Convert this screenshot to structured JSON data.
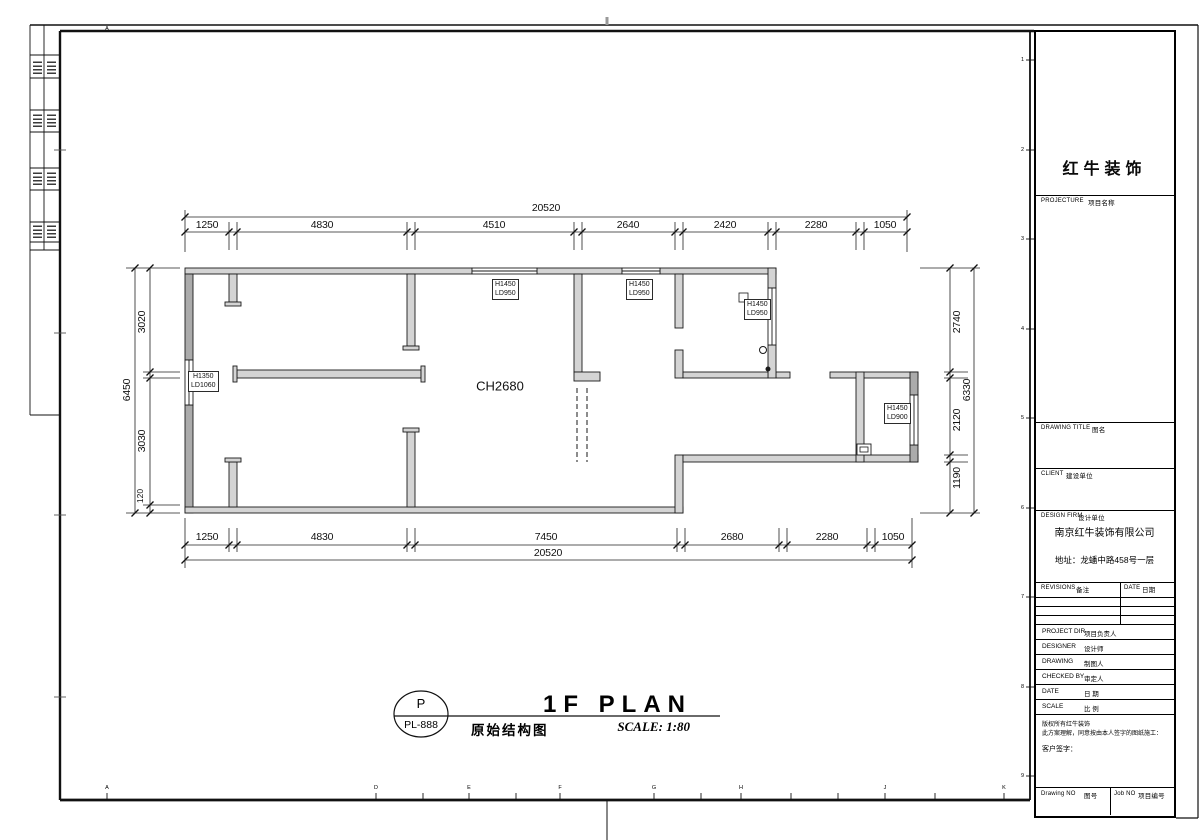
{
  "plan": {
    "ceiling_height": "CH2680",
    "tags": [
      {
        "l1": "H1450",
        "l2": "LD950"
      },
      {
        "l1": "H1450",
        "l2": "LD950"
      },
      {
        "l1": "H1450",
        "l2": "LD950"
      },
      {
        "l1": "H1350",
        "l2": "LD1060"
      },
      {
        "l1": "H1450",
        "l2": "LD900"
      }
    ],
    "dims": {
      "top": {
        "overall": "20520",
        "segments": [
          "1250",
          "4830",
          "4510",
          "2640",
          "2420",
          "2280",
          "1050"
        ]
      },
      "bottom": {
        "overall": "20520",
        "segments": [
          "1250",
          "4830",
          "7450",
          "2680",
          "2280",
          "1050"
        ]
      },
      "left": {
        "overall": "6450",
        "segments": [
          "3020",
          "3030",
          "120"
        ]
      },
      "right": {
        "overall": "6330",
        "segments": [
          "2740",
          "2120",
          "1190"
        ]
      }
    }
  },
  "title_area": {
    "bubble_letter": "P",
    "bubble_code": "PL-888",
    "title_en": "1F PLAN",
    "title_cn": "原始结构图",
    "scale": "SCALE: 1:80"
  },
  "title_block": {
    "company": "红牛装饰",
    "project_label": "PROJECTURE",
    "project_cn": "项目名称",
    "drawing_title_label": "DRAWING TITLE",
    "drawing_title_cn": "图名",
    "client_label": "CLIENT",
    "client_cn": "建设单位",
    "design_firm_label": "DESIGN FIRM",
    "design_firm_cn": "设计单位",
    "firm_name": "南京红牛装饰有限公司",
    "firm_address": "地址：龙蟠中路458号一层",
    "revisions_label": "REVISIONS",
    "revisions_cn": "备注",
    "date_col_label": "DATE",
    "date_col_cn": "日期",
    "rows": [
      {
        "en": "PROJECT DIR",
        "cn": "项目负责人"
      },
      {
        "en": "DESIGNER",
        "cn": "设计师"
      },
      {
        "en": "DRAWING",
        "cn": "制图人"
      },
      {
        "en": "CHECKED BY",
        "cn": "审定人"
      },
      {
        "en": "DATE",
        "cn": "日 期"
      },
      {
        "en": "SCALE",
        "cn": "比 例"
      }
    ],
    "copyright_line1": "版权所有红牛装饰",
    "copyright_line2": "此方案理解，同意按由本人签字的图纸施工：",
    "customer_sign": "客户签字：",
    "drawing_no_label": "Drawing NO",
    "drawing_no_cn": "图号",
    "job_no_label": "Job NO",
    "job_no_cn": "项目编号"
  },
  "frame": {
    "top_letter": "A",
    "bottom_letters": [
      "A",
      "D",
      "E",
      "F",
      "G",
      "H",
      "J",
      "K"
    ],
    "row_numbers": [
      "1",
      "2",
      "3",
      "4",
      "5",
      "6",
      "7",
      "8",
      "9"
    ]
  }
}
